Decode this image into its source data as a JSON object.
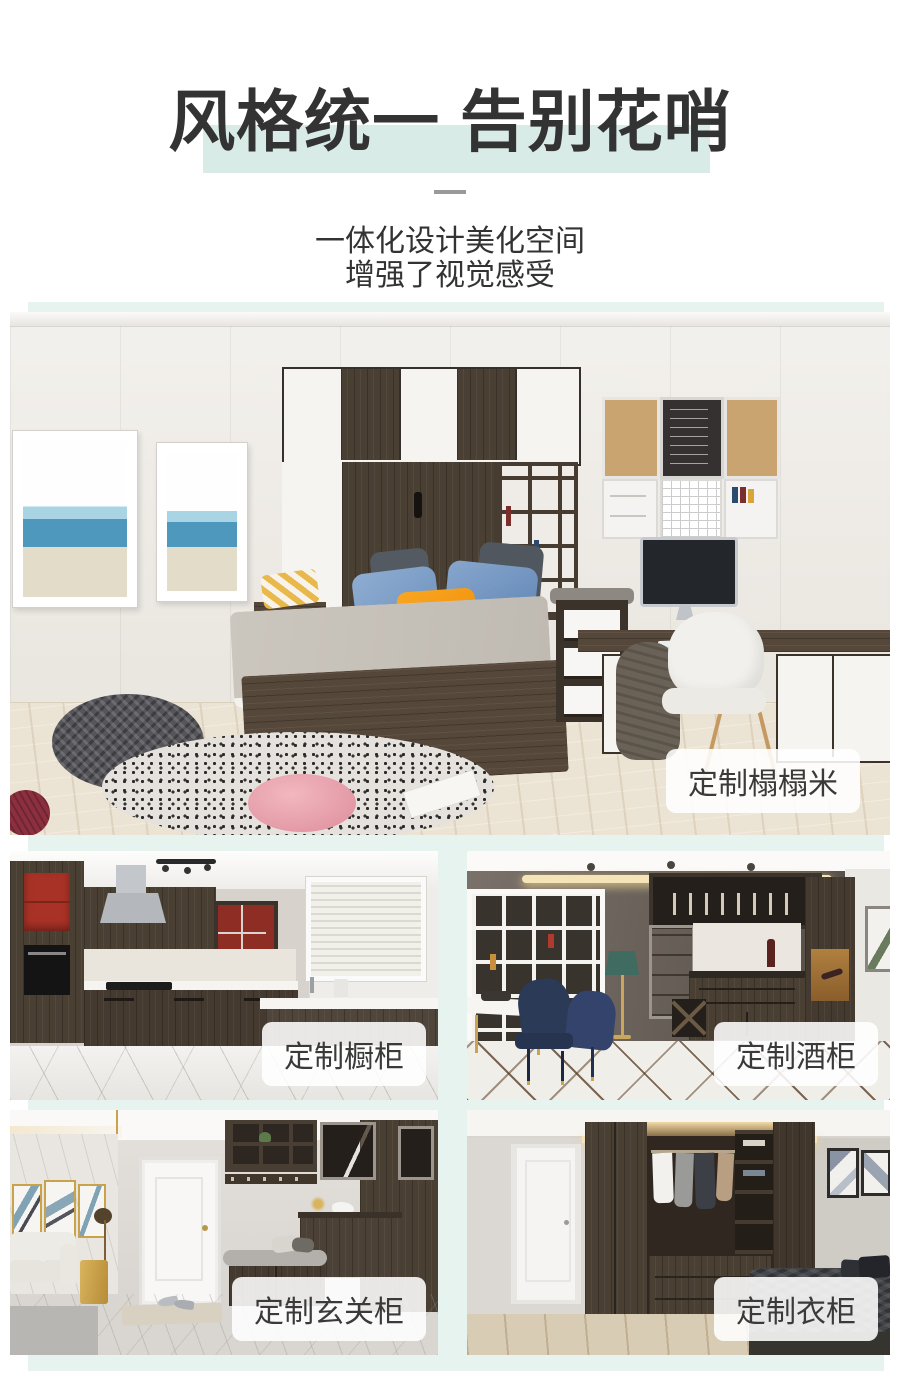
{
  "header": {
    "title": "风格统一 告别花哨",
    "subtitle_lines": [
      "一体化设计美化空间",
      "增强了视觉感受"
    ]
  },
  "colors": {
    "title_text": "#333333",
    "title_highlight": "#d9ebe6",
    "panel_mint": "#e7f3ef",
    "label_background": "rgba(255,255,255,0.88)",
    "label_text": "#3a3a3a"
  },
  "gallery": {
    "hero": {
      "name": "custom-tatami-room",
      "label": "定制榻榻米"
    },
    "items": [
      {
        "name": "custom-kitchen-cabinets",
        "label": "定制橱柜"
      },
      {
        "name": "custom-wine-cabinet",
        "label": "定制酒柜"
      },
      {
        "name": "custom-entryway-cabinet",
        "label": "定制玄关柜"
      },
      {
        "name": "custom-wardrobe",
        "label": "定制衣柜"
      }
    ]
  }
}
